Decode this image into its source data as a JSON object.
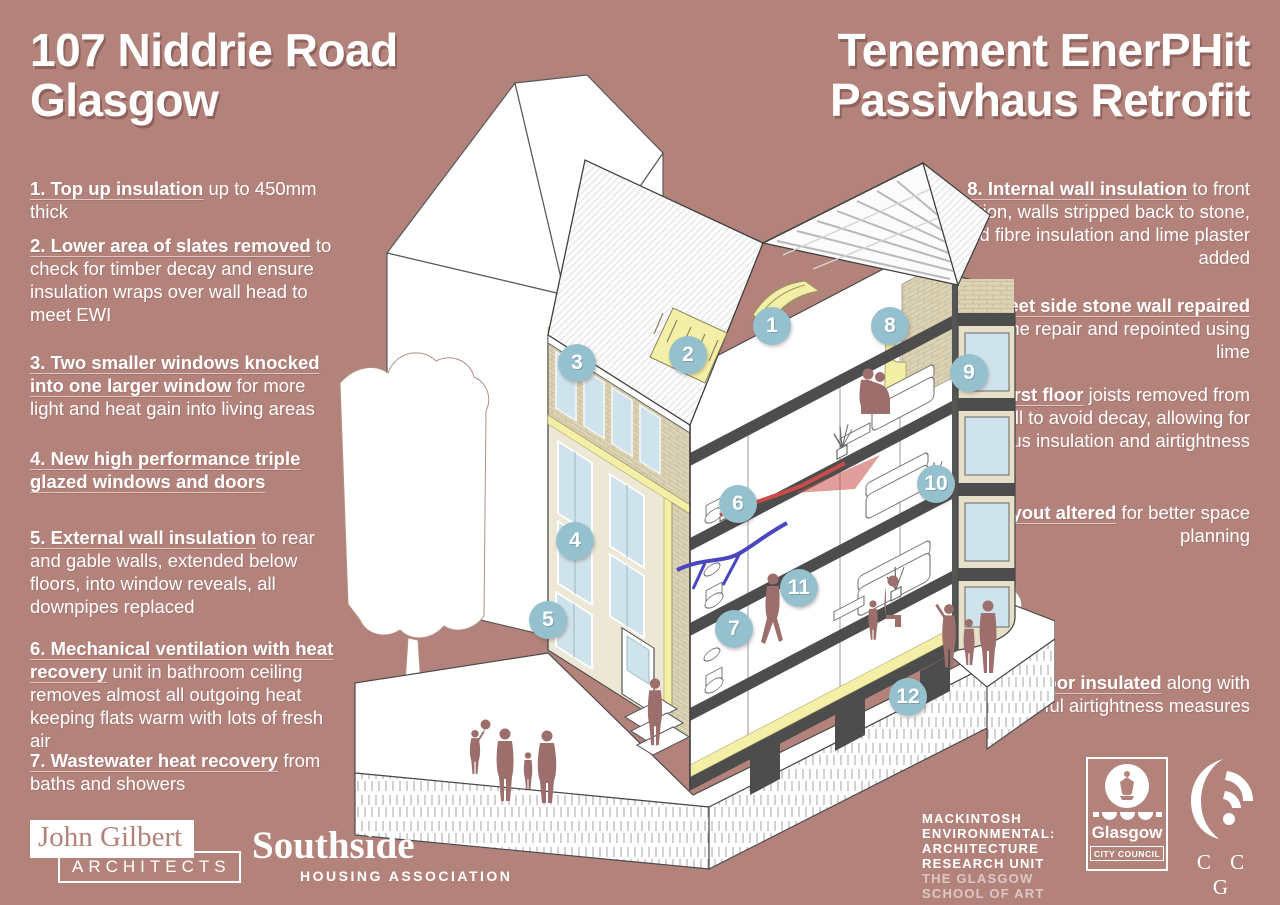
{
  "colors": {
    "background": "#b3837b",
    "marker": "#95c1cf",
    "insulation_yellow": "#f3efa6",
    "ewi_cream": "#ece8d5",
    "brick": "#dbd3b4",
    "slab_grey": "#4d4d4d",
    "window_blue": "#cfe3ec",
    "figure_mauve": "#9c6e6c",
    "duct_red": "#c94b4b",
    "duct_blue": "#4946c0"
  },
  "header": {
    "title_left_line1": "107 Niddrie Road",
    "title_left_line2": "Glasgow",
    "title_right_line1": "Tenement EnerPHit",
    "title_right_line2": "Passivhaus Retrofit"
  },
  "annotations": {
    "left": [
      {
        "num": "1.",
        "lead": "Top up insulation",
        "rest": "up to 450mm thick"
      },
      {
        "num": "2.",
        "lead": "Lower area of slates removed",
        "rest": "to check for timber decay and ensure insulation wraps over wall head to meet EWI"
      },
      {
        "num": "3.",
        "lead": "Two smaller windows knocked into one larger window",
        "rest": "for more light and heat gain into living areas"
      },
      {
        "num": "4.",
        "lead": "New high performance triple glazed windows and doors",
        "rest": ""
      },
      {
        "num": "5.",
        "lead": "External wall insulation",
        "rest": "to rear and gable walls, extended below floors, into window reveals, all downpipes replaced"
      },
      {
        "num": "6.",
        "lead": "Mechanical ventilation with heat recovery",
        "rest": "unit in bathroom ceiling removes almost all outgoing heat keeping flats warm with lots of fresh air"
      },
      {
        "num": "7.",
        "lead": "Wastewater heat recovery",
        "rest": "from baths and showers"
      }
    ],
    "right": [
      {
        "num": "8.",
        "lead": "Internal wall insulation",
        "rest": "to front elevation, walls stripped back to stone, wood fibre insulation and lime plaster added"
      },
      {
        "num": "9.",
        "lead": "Street side stone wall repaired",
        "rest": "with stone repair and repointed using lime"
      },
      {
        "num": "10.",
        "lead": "First floor",
        "rest": "joists removed from wall to avoid decay, allowing for continuous insulation and airtightness"
      },
      {
        "num": "11.",
        "lead": "Layout altered",
        "rest": "for better space planning"
      },
      {
        "num": "12.",
        "lead": "Ground floor insulated",
        "rest": "along with careful airtightness measures"
      }
    ]
  },
  "illustration": {
    "markers": [
      {
        "n": "1",
        "x": 447,
        "y": 261
      },
      {
        "n": "2",
        "x": 363,
        "y": 290
      },
      {
        "n": "3",
        "x": 252,
        "y": 298
      },
      {
        "n": "4",
        "x": 250,
        "y": 476
      },
      {
        "n": "5",
        "x": 223,
        "y": 555
      },
      {
        "n": "6",
        "x": 413,
        "y": 439
      },
      {
        "n": "7",
        "x": 409,
        "y": 564
      },
      {
        "n": "8",
        "x": 565,
        "y": 261
      },
      {
        "n": "9",
        "x": 644,
        "y": 308
      },
      {
        "n": "10",
        "x": 611,
        "y": 419
      },
      {
        "n": "11",
        "x": 474,
        "y": 523
      },
      {
        "n": "12",
        "x": 583,
        "y": 632
      }
    ]
  },
  "logos": {
    "john_gilbert": {
      "line1": "John Gilbert",
      "line2": "ARCHITECTS"
    },
    "southside": {
      "name": "Southside",
      "sub": "HOUSING ASSOCIATION"
    },
    "mearu": {
      "lines": [
        "MACKINTOSH",
        "ENVIRONMENTAL:",
        "ARCHITECTURE",
        "RESEARCH UNIT"
      ],
      "sub_lines": [
        "THE GLASGOW",
        "SCHOOL OF ART"
      ]
    },
    "glasgow": {
      "name": "Glasgow",
      "sub": "CITY COUNCIL"
    },
    "ccg": {
      "name": "C C G"
    }
  }
}
